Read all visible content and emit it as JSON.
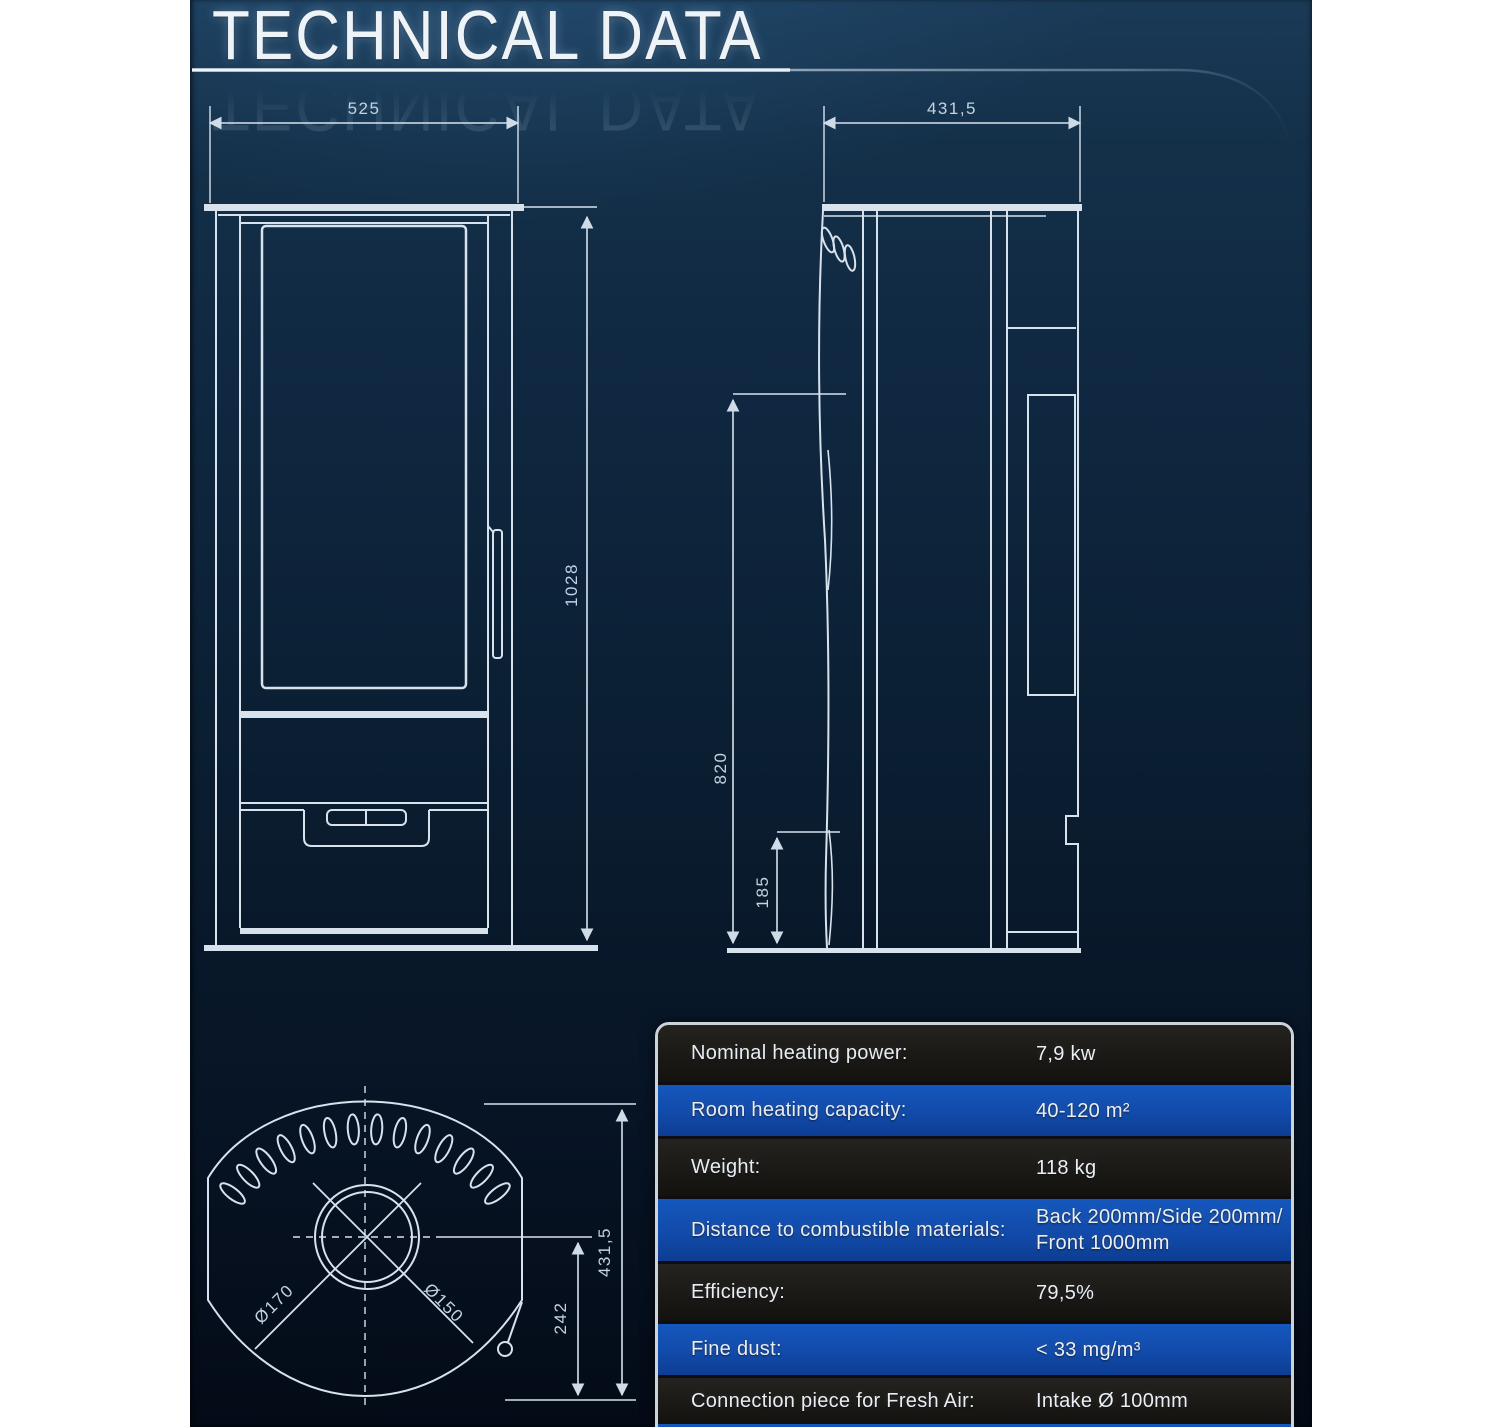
{
  "title": "TECHNICAL DATA",
  "specs": {
    "rows": [
      {
        "label": "Nominal heating power:",
        "value": "7,9 kw",
        "variant": "dark"
      },
      {
        "label": "Room heating capacity:",
        "value": "40-120 m²",
        "variant": "blue"
      },
      {
        "label": "Weight:",
        "value": "118 kg",
        "variant": "dark"
      },
      {
        "label": "Distance to combustible materials:",
        "value": "Back 200mm/Side 200mm/",
        "value_line2": "Front 1000mm",
        "variant": "blue"
      },
      {
        "label": "Efficiency:",
        "value": "79,5%",
        "variant": "dark"
      },
      {
        "label": "Fine dust:",
        "value": "< 33 mg/m³",
        "variant": "blue"
      },
      {
        "label": "Connection piece for Fresh Air:",
        "value": "Intake Ø 100mm",
        "variant": "dark"
      }
    ],
    "colors": {
      "blue_row": "#1150b4",
      "dark_row": "#1b1916",
      "border": "#ccd4da"
    }
  },
  "drawings": {
    "front_view": {
      "width_mm": "525",
      "height_mm": "1028"
    },
    "side_view": {
      "depth_mm": "431,5",
      "upper_mm": "820",
      "lower_mm": "185"
    },
    "top_view": {
      "flue_outer": "Ø170",
      "flue_inner": "Ø150",
      "center_mm": "242",
      "depth_mm": "431,5"
    }
  },
  "colors": {
    "panel_top": "#1a3a57",
    "panel_bottom": "#040b17",
    "line": "#d7e2ed",
    "dim_text": "#c3d3e1"
  }
}
